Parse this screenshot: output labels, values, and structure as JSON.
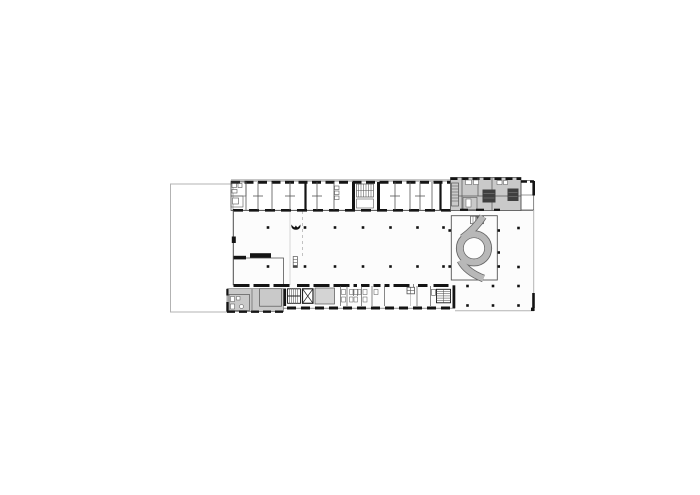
{
  "figure": {
    "kind": "architectural floor plan",
    "orientation": "landscape",
    "features": [
      "adjacent lot outline",
      "north room band",
      "open hall with column grid",
      "northeast service block",
      "circular ramp court",
      "south room band",
      "stair cores",
      "elevator"
    ]
  },
  "colors": {
    "background": "#ffffff",
    "wall": "#141414",
    "line": "#555555",
    "light_line": "#b3b3b3",
    "interior": "#fcfcfc",
    "service_gray": "#c9c9c9",
    "room_gray": "#d4d4d4",
    "ramp_gray": "#b8b8b8",
    "ramp_line": "#666666"
  },
  "columns": {
    "dot_size": 2.6,
    "hall_rows": {
      "xs": [
        268,
        305,
        335,
        363,
        390.5,
        417.5,
        443.5
      ],
      "ys": [
        227.5,
        266.5
      ]
    },
    "east_dots": [
      [
        449.7,
        230.5
      ],
      [
        449.7,
        266.5
      ],
      [
        498.7,
        230.5
      ],
      [
        498.7,
        252.5
      ],
      [
        498.7,
        266.5
      ],
      [
        467.5,
        286
      ],
      [
        493,
        286
      ],
      [
        518.5,
        286
      ],
      [
        518.5,
        228
      ],
      [
        518.5,
        267
      ],
      [
        467.5,
        305.5
      ],
      [
        493,
        305.5
      ],
      [
        518.5,
        305.5
      ]
    ]
  }
}
